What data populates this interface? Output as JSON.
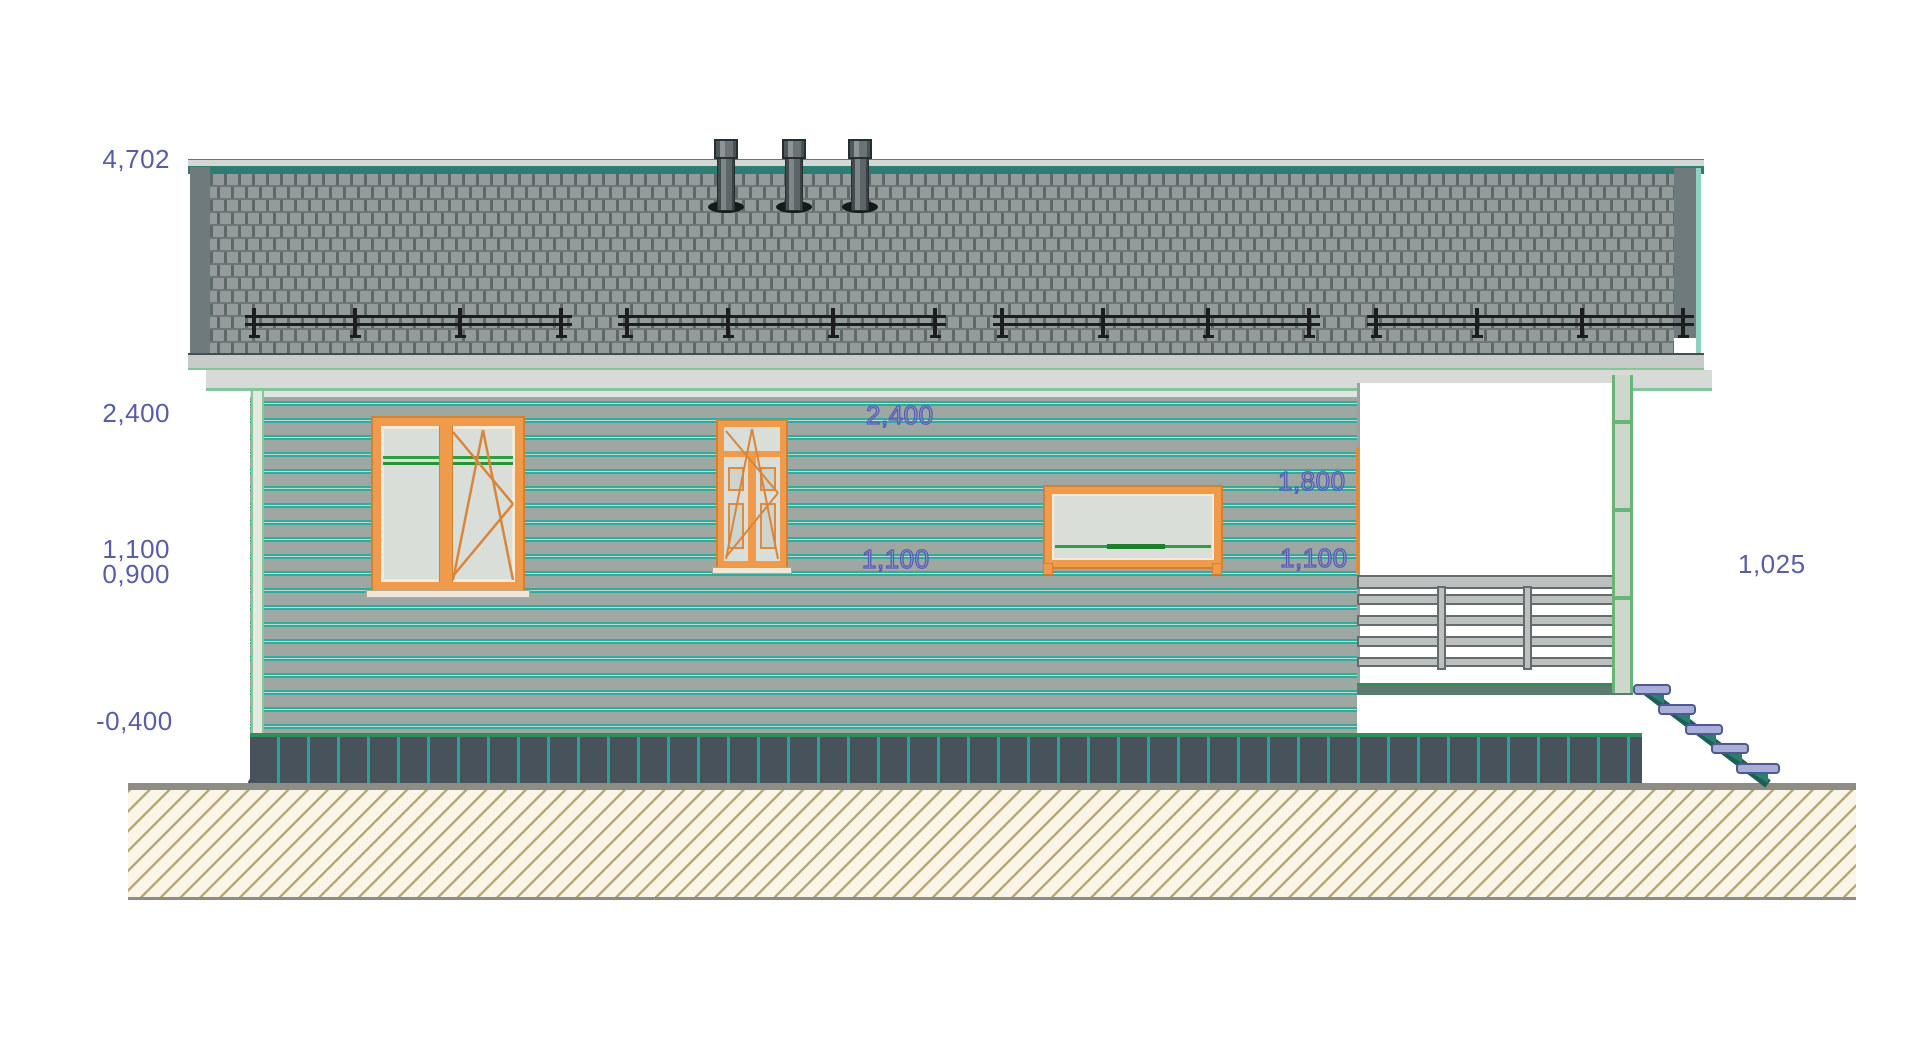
{
  "figure": {
    "kind": "house side elevation (CAD drawing)",
    "chimney_count": 3,
    "stair_step_count": 5,
    "snow_guard_segments": 4,
    "window_count": 2,
    "door_count": 1
  },
  "labels": {
    "left_levels": [
      "4,702",
      "2,400",
      "1,100",
      "0,900",
      "-0,400"
    ],
    "wall_marks": [
      "2,400",
      "1,100"
    ],
    "porch_marks": [
      "1,800",
      "1,100"
    ],
    "right_marks": [
      "1,025"
    ]
  },
  "colors": {
    "label_blue": "#585da6",
    "siding_grey": "#9fa7a3",
    "siding_stripe_teal": "#32ab9c",
    "window_frame_orange": "#ef9b4b",
    "roof_shingle_grey": "#939c9b",
    "roof_ridge_teal": "#2e7d72",
    "plinth_dark": "#47525a",
    "plinth_stripe_teal": "#2ba396",
    "ground_hatch_tan": "#b3a56f",
    "stair_tread_lavender": "#a9aed8",
    "stair_stringer_teal": "#1d5f55",
    "accent_green": "#2f9e3f"
  }
}
